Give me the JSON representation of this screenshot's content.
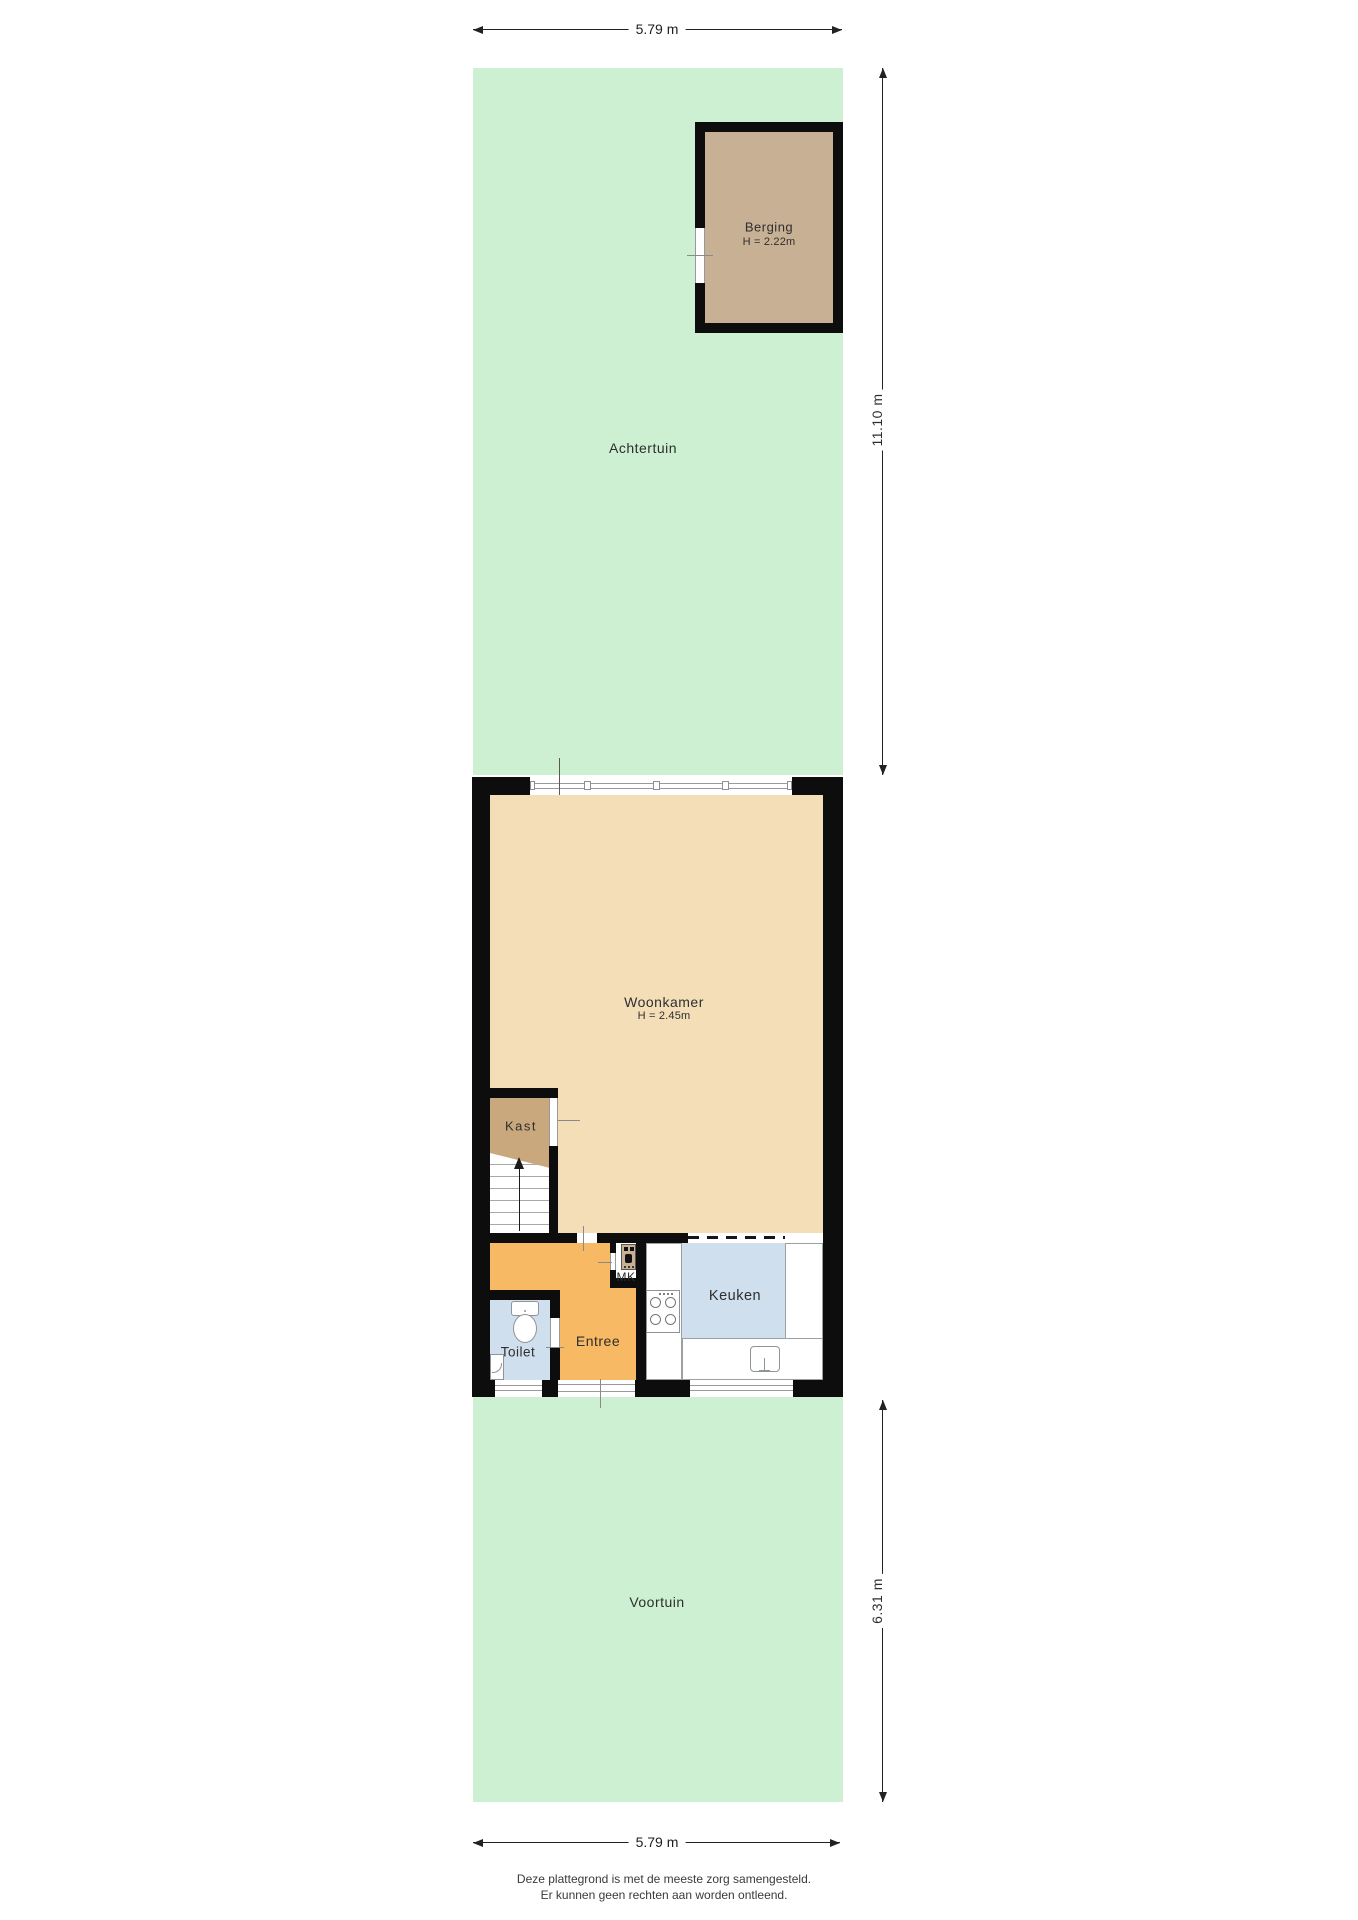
{
  "plan": {
    "title": "Plattegrond begane grond",
    "dimensions": {
      "top_width": "5.79 m",
      "back_garden_depth": "11.10 m",
      "front_garden_depth": "6.31 m",
      "bottom_width": "5.79 m"
    },
    "areas": {
      "back_garden": "Achtertuin",
      "front_garden": "Voortuin"
    },
    "rooms": {
      "berging": {
        "name": "Berging",
        "height": "H = 2.22m"
      },
      "woonkamer": {
        "name": "Woonkamer",
        "height": "H = 2.45m"
      },
      "kast": {
        "name": "Kast"
      },
      "mk": {
        "name": "MK"
      },
      "keuken": {
        "name": "Keuken"
      },
      "toilet": {
        "name": "Toilet"
      },
      "entree": {
        "name": "Entree"
      }
    },
    "footer": {
      "line1": "Deze plattegrond is met de meeste zorg samengesteld.",
      "line2": "Er kunnen geen rechten aan worden ontleend."
    },
    "colors": {
      "garden": "#cdf0d2",
      "wood": "#f3deb8",
      "wood_dark": "#c9a87e",
      "berging_floor": "#c8b094",
      "entree_floor": "#f7b964",
      "tile_blue": "#cfdfed",
      "wall": "#0d0d0d"
    }
  }
}
